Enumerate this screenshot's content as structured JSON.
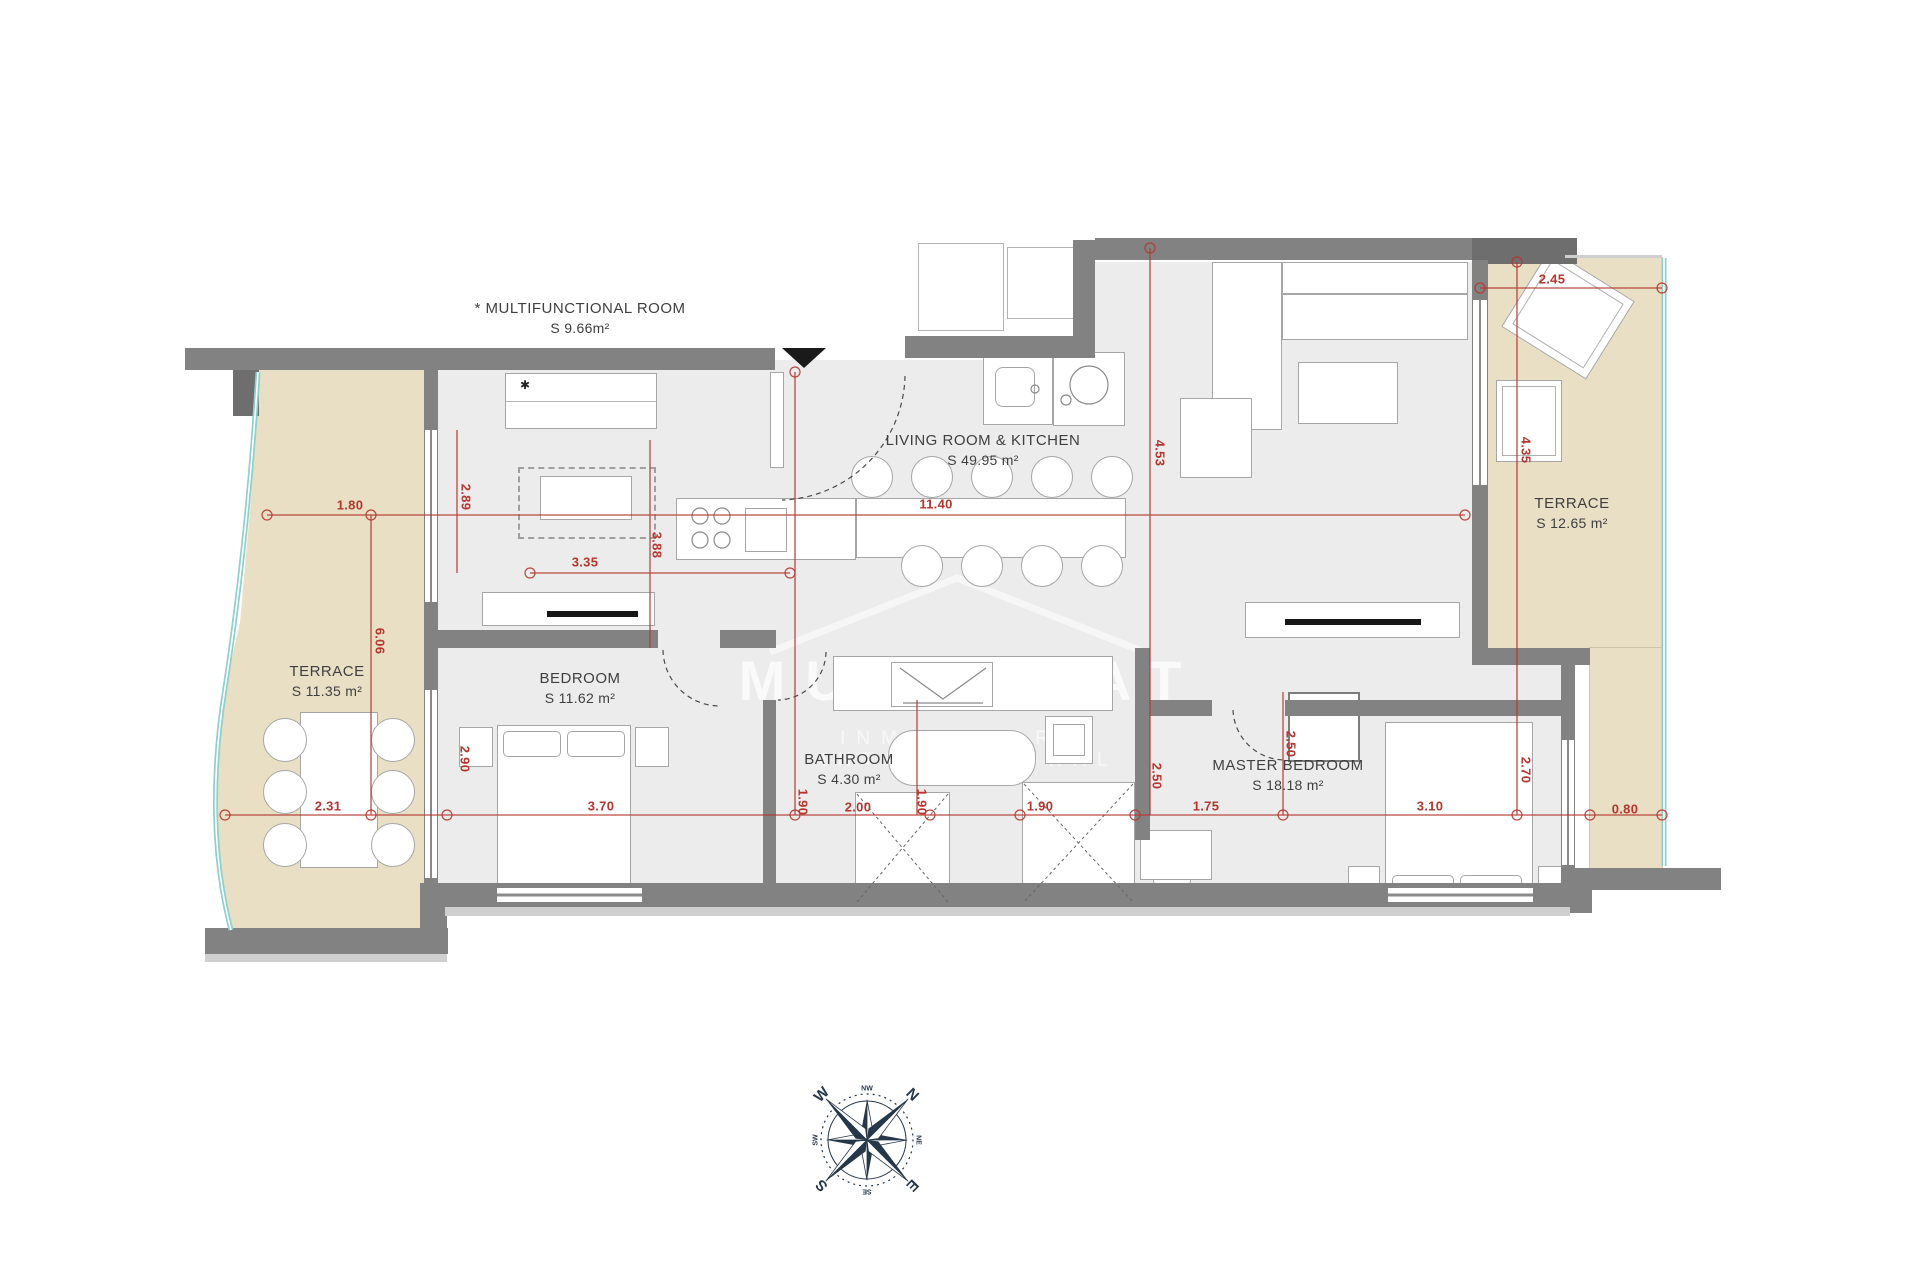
{
  "rooms": [
    {
      "name": "* MULTIFUNCTIONAL ROOM",
      "area": "S 9.66m²"
    },
    {
      "name": "LIVING ROOM & KITCHEN",
      "area": "S 49.95 m²"
    },
    {
      "name": "TERRACE",
      "area": "S 12.65 m²"
    },
    {
      "name": "TERRACE",
      "area": "S 11.35 m²"
    },
    {
      "name": "BEDROOM",
      "area": "S 11.62 m²"
    },
    {
      "name": "BATHROOM",
      "area": "S 4.30 m²"
    },
    {
      "name": "MASTER BEDROOM",
      "area": "S 18.18 m²"
    }
  ],
  "dimensions": [
    {
      "value": "1.80",
      "orientation": "horizontal"
    },
    {
      "value": "2.89",
      "orientation": "vertical"
    },
    {
      "value": "3.35",
      "orientation": "horizontal"
    },
    {
      "value": "3.88",
      "orientation": "vertical"
    },
    {
      "value": "11.40",
      "orientation": "horizontal"
    },
    {
      "value": "4.53",
      "orientation": "vertical"
    },
    {
      "value": "2.45",
      "orientation": "horizontal"
    },
    {
      "value": "4.35",
      "orientation": "vertical"
    },
    {
      "value": "6.06",
      "orientation": "vertical"
    },
    {
      "value": "2.90",
      "orientation": "vertical"
    },
    {
      "value": "2.31",
      "orientation": "horizontal"
    },
    {
      "value": "3.70",
      "orientation": "horizontal"
    },
    {
      "value": "1.90",
      "orientation": "vertical"
    },
    {
      "value": "2.00",
      "orientation": "horizontal"
    },
    {
      "value": "1.90",
      "orientation": "vertical"
    },
    {
      "value": "1.90",
      "orientation": "horizontal"
    },
    {
      "value": "2.50",
      "orientation": "vertical"
    },
    {
      "value": "1.75",
      "orientation": "horizontal"
    },
    {
      "value": "2.50",
      "orientation": "vertical"
    },
    {
      "value": "3.10",
      "orientation": "horizontal"
    },
    {
      "value": "2.70",
      "orientation": "vertical"
    },
    {
      "value": "0.80",
      "orientation": "horizontal"
    }
  ],
  "watermark": {
    "title": "MUNESTAT",
    "subtitle": "INMOBILIARIA INTERNACIONAL"
  },
  "compass": {
    "n": "N",
    "e": "E",
    "s": "S",
    "w": "W",
    "nw": "NW",
    "ne": "NE",
    "se": "SE",
    "sw": "SW"
  },
  "colors": {
    "terrace": "#e8dfc5",
    "wall": "#828282",
    "dimension_red": "#b5362f",
    "compass_navy": "#26374a",
    "waterline_teal": "#8ccfcd"
  }
}
